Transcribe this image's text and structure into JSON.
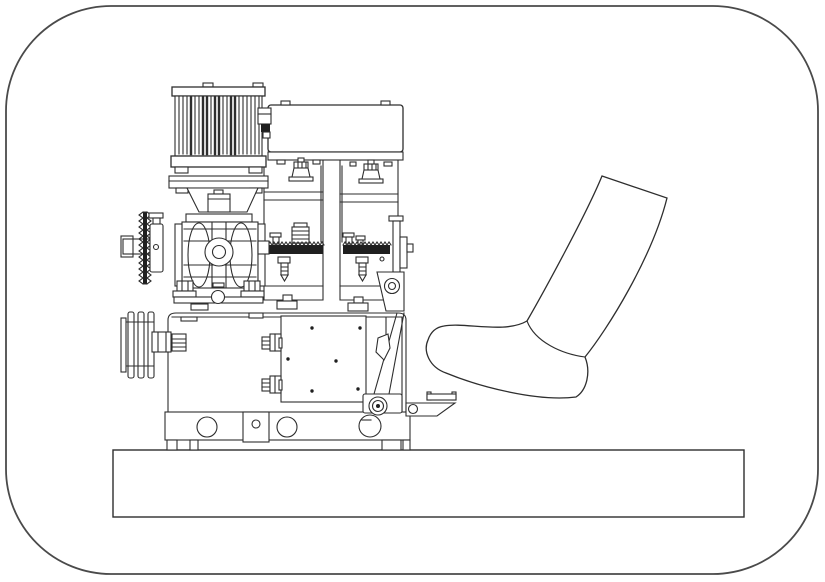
{
  "figure": {
    "kind": "technical-line-drawing",
    "description": "Patent-style monochrome line drawing of a pedal-operated machine: a finned electric motor mounted on a worm gearbox with a chain sprocket and input shaft, a V-belt pulley, a clamping press unit with cable glands and serrated jaws, a release lever with roller bolt, a housing with mounting holes on a base plate, and a human foot in a sock pressing toward a pedal bracket, all framed by a rounded-rectangle border.",
    "colors": {
      "line": "#2e2e2e",
      "ink": "#1f1f1f",
      "border": "#4a4a4a",
      "background": "#ffffff"
    },
    "components": [
      {
        "id": "border-frame",
        "label": "rounded border frame"
      },
      {
        "id": "base-plate",
        "label": "base plate"
      },
      {
        "id": "machine-housing",
        "label": "machine housing with mounting-hole band and feet"
      },
      {
        "id": "terminal-panel",
        "label": "terminal panel with screw holes and cable glands"
      },
      {
        "id": "clamp-unit",
        "label": "clamping press unit with serrated jaws"
      },
      {
        "id": "v-belt-pulley",
        "label": "V-belt pulley"
      },
      {
        "id": "chain-sprocket",
        "label": "chain sprocket and input shaft"
      },
      {
        "id": "worm-gearbox",
        "label": "worm gearbox"
      },
      {
        "id": "motor-flange",
        "label": "motor mounting flange"
      },
      {
        "id": "electric-motor",
        "label": "finned electric motor with junction box"
      },
      {
        "id": "release-lever",
        "label": "release lever with pivot and roller bolt"
      },
      {
        "id": "pedal-bracket",
        "label": "foot pedal bracket"
      },
      {
        "id": "human-foot",
        "label": "human foot in sock pressing the pedal"
      }
    ]
  }
}
